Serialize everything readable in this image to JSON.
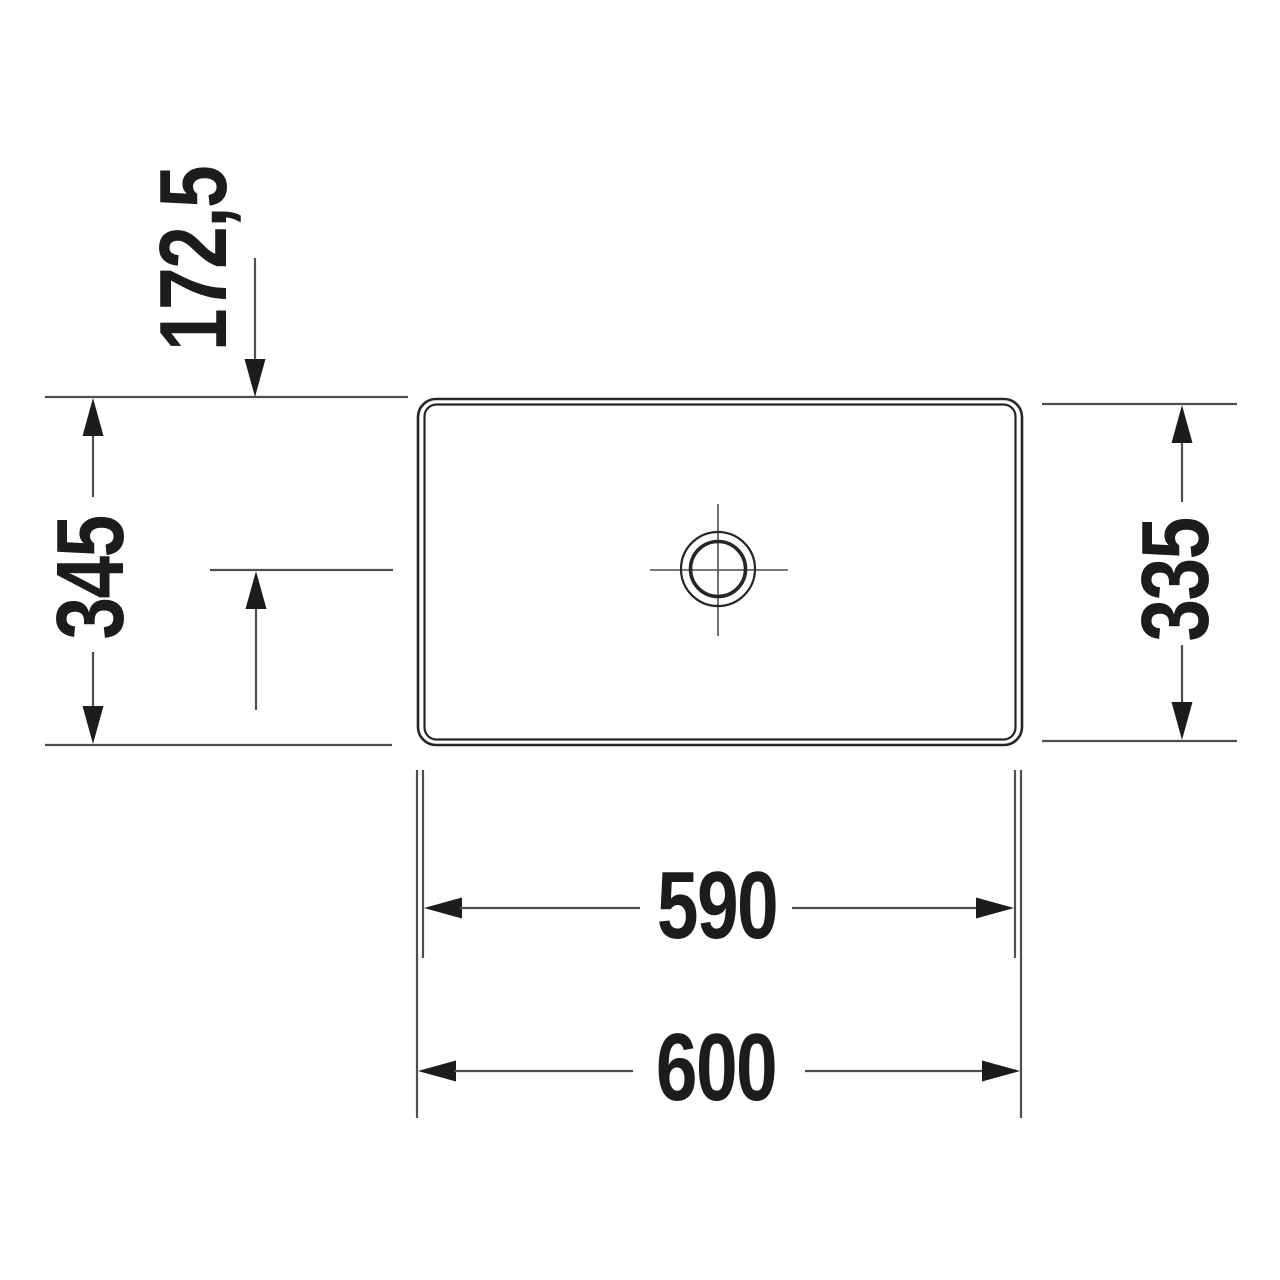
{
  "drawing": {
    "labels": {
      "top_offset": "172,5",
      "left_depth": "345",
      "right_depth": "335",
      "inner_width": "590",
      "outer_width": "600"
    },
    "colors": {
      "background": "#ffffff",
      "line": "#4f4f4f",
      "outline": "#262626",
      "text": "#1c1c1c"
    }
  }
}
